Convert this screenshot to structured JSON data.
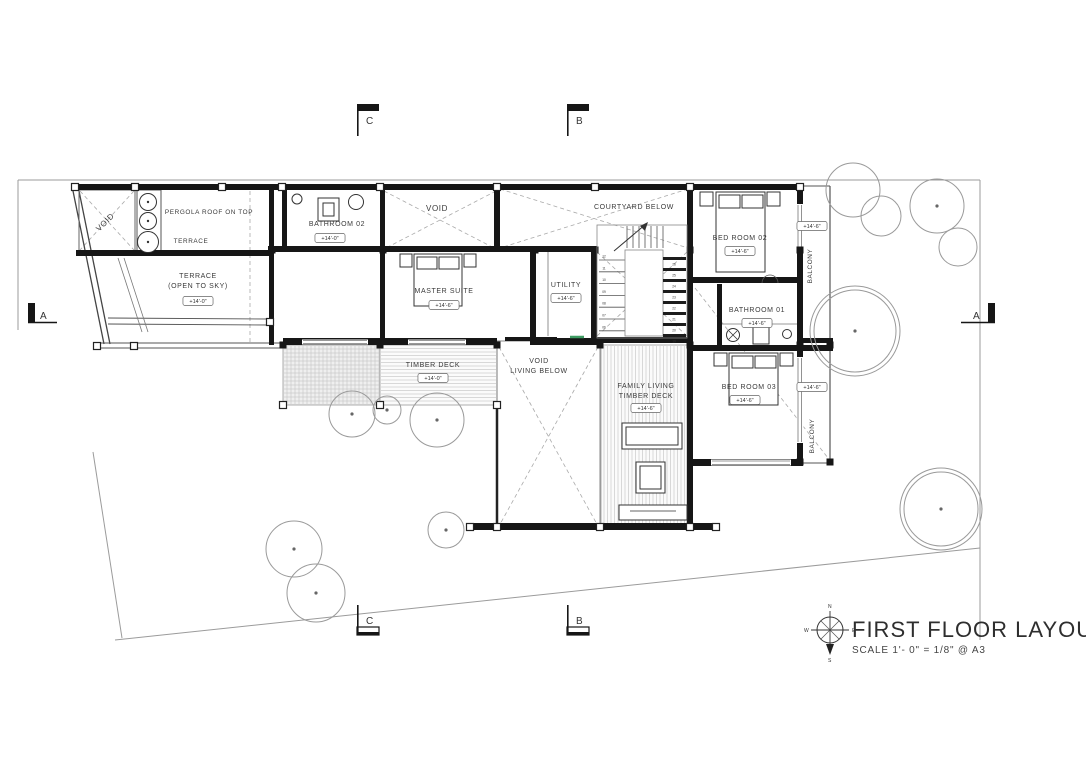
{
  "drawing": {
    "title": "FIRST FLOOR LAYOUT",
    "scale_note": "SCALE 1'- 0\" = 1/8\" @ A3"
  },
  "compass": {
    "north": "N",
    "east": "E",
    "south": "S",
    "west": "W"
  },
  "section_markers": {
    "top_c": "C",
    "top_b": "B",
    "left_a": "A",
    "right_a": "A",
    "bottom_c": "C",
    "bottom_b": "B"
  },
  "labels": [
    {
      "name": "void-upper-left",
      "text": "VOID",
      "x": 107,
      "y": 224,
      "size": 8,
      "rotate": -45
    },
    {
      "name": "pergola-roof-on-top",
      "text": "PERGOLA ROOF ON TOP",
      "x": 209,
      "y": 214,
      "size": 6.4
    },
    {
      "name": "terrace-strip",
      "text": "TERRACE",
      "x": 191,
      "y": 243,
      "size": 6.4
    },
    {
      "name": "terrace-open-to-sky",
      "lines": [
        "TERRACE",
        "(OPEN TO SKY)"
      ],
      "x": 198,
      "y": 278,
      "size": 7,
      "tag": "+14'-0\"",
      "tagY": 303
    },
    {
      "name": "bathroom-02",
      "text": "BATHROOM 02",
      "x": 337,
      "y": 226,
      "size": 7,
      "tag": "+14'-0\"",
      "tagX": 330,
      "tagY": 240
    },
    {
      "name": "void-center",
      "text": "VOID",
      "x": 437,
      "y": 211,
      "size": 8
    },
    {
      "name": "master-suite",
      "text": "MASTER SUITE",
      "x": 444,
      "y": 293,
      "size": 7,
      "tag": "+14'-6\"",
      "tagY": 307
    },
    {
      "name": "utility",
      "text": "UTILITY",
      "x": 566,
      "y": 287,
      "size": 7,
      "tag": "+14'-6\"",
      "tagY": 300
    },
    {
      "name": "courtyard-below",
      "text": "COURTYARD BELOW",
      "x": 634,
      "y": 209,
      "size": 7
    },
    {
      "name": "bed-room-02",
      "text": "BED ROOM 02",
      "x": 740,
      "y": 240,
      "size": 7,
      "tag": "+14'-6\"",
      "tagY": 253
    },
    {
      "name": "balcony-north",
      "text": "BALCONY",
      "x": 812,
      "y": 266,
      "size": 6.4,
      "rotate": -90,
      "tag": "+14'-6\"",
      "tagX": 812,
      "tagY": 228
    },
    {
      "name": "bathroom-01",
      "text": "BATHROOM 01",
      "x": 757,
      "y": 312,
      "size": 7,
      "tag": "+14'-6\"",
      "tagY": 325
    },
    {
      "name": "bed-room-03",
      "text": "BED ROOM 03",
      "x": 749,
      "y": 389,
      "size": 7,
      "tag": "+14'-6\"",
      "tagX": 745,
      "tagY": 402
    },
    {
      "name": "balcony-south",
      "text": "BALCONY",
      "x": 814,
      "y": 436,
      "size": 6.4,
      "rotate": -90,
      "tag": "+14'-6\"",
      "tagX": 812,
      "tagY": 389
    },
    {
      "name": "timber-deck",
      "text": "TIMBER DECK",
      "x": 433,
      "y": 367,
      "size": 7,
      "tag": "+14'-0\"",
      "tagY": 380
    },
    {
      "name": "void-living-below",
      "lines": [
        "VOID",
        "LIVING BELOW"
      ],
      "x": 539,
      "y": 363,
      "size": 7
    },
    {
      "name": "family-living-timber-deck",
      "lines": [
        "FAMILY LIVING",
        "TIMBER DECK"
      ],
      "x": 646,
      "y": 388,
      "size": 7,
      "tag": "+14'-6\"",
      "tagY": 410
    }
  ],
  "stairs": {
    "top_numbers": [
      "13",
      "14",
      "15",
      "16",
      "17",
      "18"
    ],
    "left_numbers": [
      "12",
      "11",
      "10",
      "09",
      "08",
      "07",
      "06"
    ],
    "right_numbers": [
      "26",
      "25",
      "24",
      "23",
      "22",
      "21",
      "20",
      "19"
    ]
  }
}
